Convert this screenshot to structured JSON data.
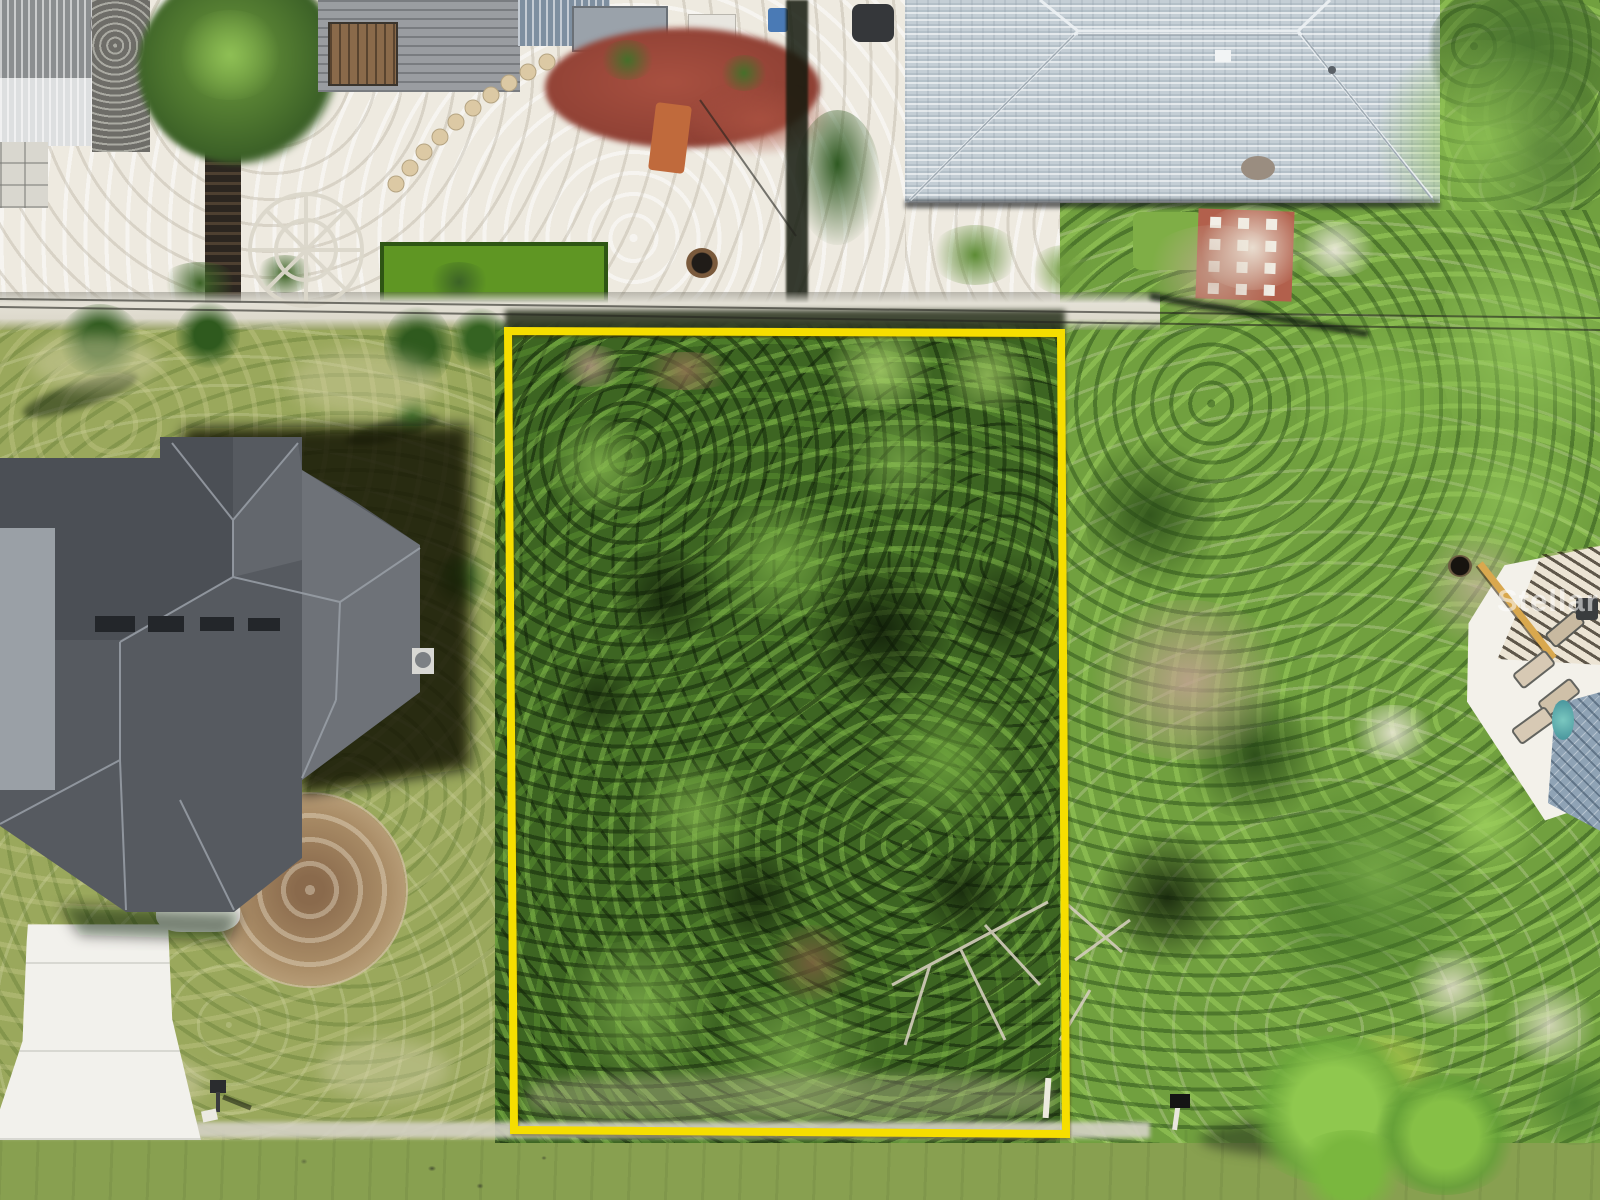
{
  "scene": {
    "description": "Aerial drone photo of a vacant wooded residential lot outlined in yellow between neighboring homes, with a road along the bottom edge",
    "watermark": "StellarMLS"
  },
  "lot_boundary": {
    "points": "508,331 1061,333 1066,1134 514,1130",
    "color": "#F6DE00",
    "stroke_width": 8
  },
  "palette": {
    "road_asphalt": "#8D8E90",
    "lot_vegetation": "#3D6522",
    "left_grass": "#9AA85C",
    "right_vegetation": "#71A03F",
    "sand": "#EEEAE0",
    "left_house_roof": "#54585E",
    "right_house_roof": "#C4CED5",
    "dirt_patch": "#A08262",
    "paver_patio": "#B2604C",
    "bocce_court": "#5F9623",
    "pool_screen": "#8FA3B5",
    "red_mulch": "#9E4A3A"
  }
}
